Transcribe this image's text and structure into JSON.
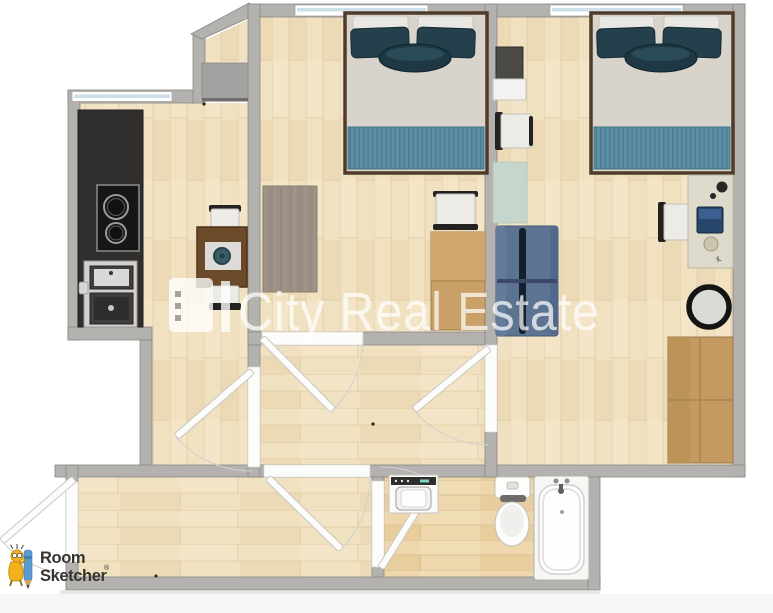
{
  "watermark": {
    "text": "City Real Estate"
  },
  "roomsketcher_logo": {
    "line1": "Room",
    "line2": "Sketcher",
    "registered_mark": "®"
  },
  "colors": {
    "wall_gray": "#b4b2af",
    "shaft_gray": "#a3a2a0",
    "wood_floor": "#f0e1c1",
    "bathroom_floor": "#eed7ac",
    "kitchen_counter_black": "#302f2e",
    "bed_throw_teal": "#5d90a6",
    "pillow_teal": "#24404c",
    "sofa_blue": "#5c7492",
    "desk_wardrobe_wood": "#c49a62",
    "mint_mat_green": "#c6d6cc",
    "rug_gray_brown": "#9c9084",
    "watermark_white": "#ffffff",
    "logo_yellow": "#f3b11d",
    "logo_pencil_blue": "#5b9bd0",
    "logo_text_dark": "#34332f"
  },
  "furniture_legend": [
    "kitchen-counter",
    "cooktop",
    "kitchen-sink-unit",
    "dining-table",
    "dining-chairs",
    "double-bed-1",
    "double-bed-2",
    "rug",
    "desk-chair",
    "desk",
    "tv-cabinet",
    "wall-chair",
    "mint-mat",
    "sofa",
    "laptop-desk",
    "round-mirror-chair",
    "wardrobe",
    "washing-machine",
    "toilet",
    "bathtub"
  ]
}
